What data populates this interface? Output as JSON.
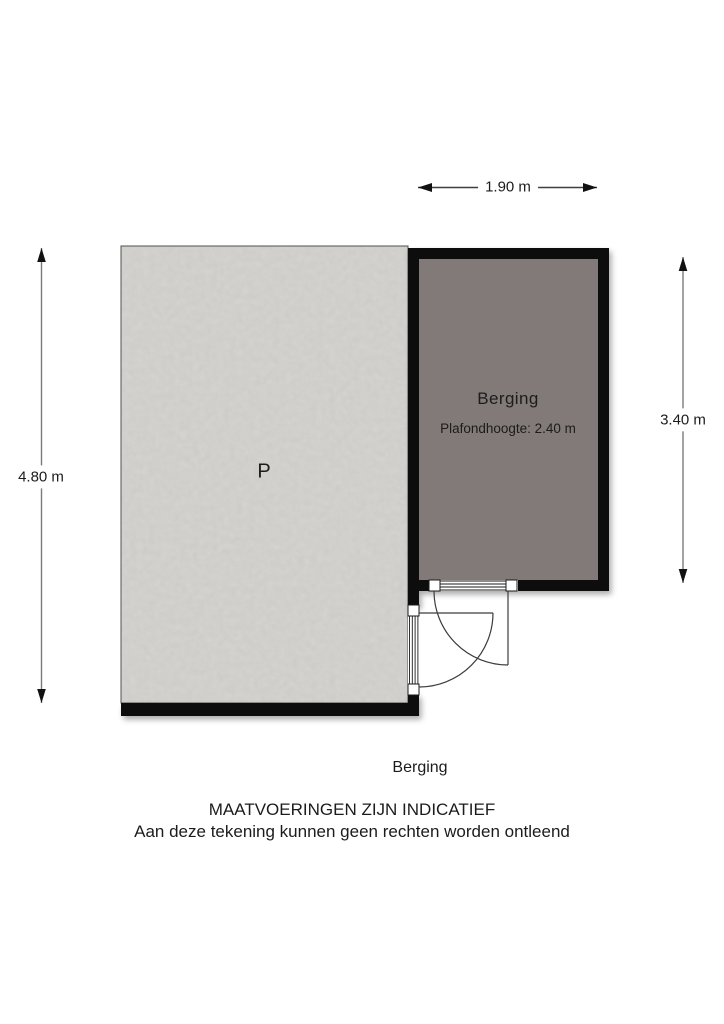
{
  "colors": {
    "wall": "#0b0b0b",
    "room-fill": "#817a78",
    "parking-base": "#d4d3d0",
    "dim-line": "#7a7a7a",
    "dim-line-dark": "#3f3f3f",
    "arrow": "#111111",
    "door-line": "#3c3c3c",
    "text": "#1c1c1c"
  },
  "plan": {
    "parking_label": "P",
    "room": {
      "name": "Berging",
      "ceiling": "Plafondhoogte: 2.40 m"
    },
    "dimensions": {
      "width_top": "1.90 m",
      "height_left": "4.80 m",
      "height_right": "3.40 m"
    }
  },
  "footer": {
    "plan_title": "Berging",
    "disclaimer1": "MAATVOERINGEN ZIJN INDICATIEF",
    "disclaimer2": "Aan deze tekening kunnen geen rechten worden ontleend"
  }
}
